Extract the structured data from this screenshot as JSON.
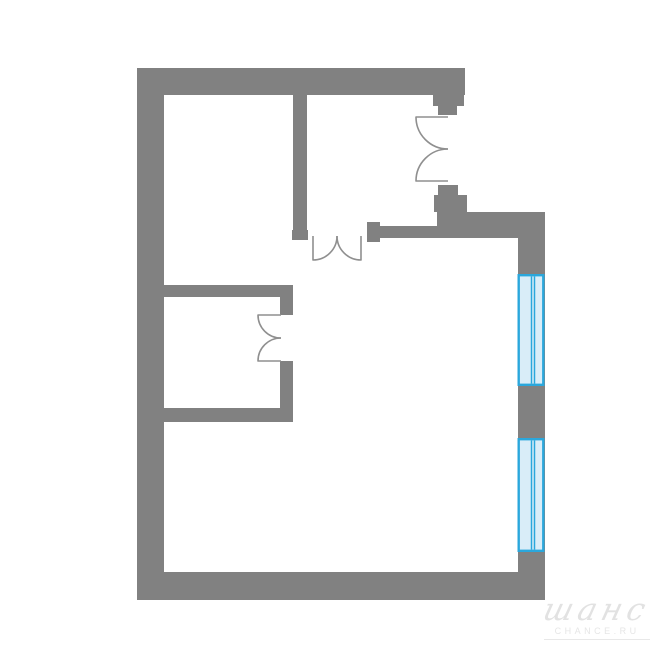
{
  "canvas": {
    "width": 670,
    "height": 670,
    "background": "#ffffff"
  },
  "colors": {
    "wall": "#818181",
    "door_line": "#8f8f8f",
    "window_border": "#2aa7dc",
    "window_fill": "#d9edf8",
    "watermark": "#e2e2e2"
  },
  "watermark": {
    "script": "шанс",
    "caption": "CHANCE.RU"
  },
  "floorplan": {
    "viewbox": "0 0 670 670",
    "walls": [
      {
        "name": "top-wall",
        "x": 137,
        "y": 68,
        "w": 328,
        "h": 27
      },
      {
        "name": "left-wall",
        "x": 137,
        "y": 68,
        "w": 27,
        "h": 532
      },
      {
        "name": "bottom-wall",
        "x": 137,
        "y": 572,
        "w": 408,
        "h": 28
      },
      {
        "name": "right-wall",
        "x": 518,
        "y": 212,
        "w": 27,
        "h": 388
      },
      {
        "name": "hall-wall",
        "x": 463,
        "y": 212,
        "w": 82,
        "h": 26
      },
      {
        "name": "entry-stub",
        "x": 437,
        "y": 195,
        "w": 26,
        "h": 43
      },
      {
        "name": "entry-stub-jamb-wide",
        "x": 434,
        "y": 195,
        "w": 33,
        "h": 17
      },
      {
        "name": "entry-stub-jamb-narrow",
        "x": 438,
        "y": 185,
        "w": 20,
        "h": 10
      },
      {
        "name": "top-wall-jamb-wide",
        "x": 433,
        "y": 95,
        "w": 31,
        "h": 11
      },
      {
        "name": "top-wall-jamb-narrow",
        "x": 438,
        "y": 106,
        "w": 19,
        "h": 9
      },
      {
        "name": "hall-partition",
        "x": 367,
        "y": 226,
        "w": 70,
        "h": 12
      },
      {
        "name": "hall-partition-jamb",
        "x": 367,
        "y": 222,
        "w": 13,
        "h": 20
      },
      {
        "name": "bedroom-partition",
        "x": 293,
        "y": 95,
        "w": 14,
        "h": 135
      },
      {
        "name": "bedroom-partition-jamb",
        "x": 292,
        "y": 230,
        "w": 16,
        "h": 10
      },
      {
        "name": "storage-top-wall",
        "x": 160,
        "y": 285,
        "w": 133,
        "h": 12
      },
      {
        "name": "storage-right-wall-top",
        "x": 280,
        "y": 297,
        "w": 13,
        "h": 18
      },
      {
        "name": "storage-right-wall-bottom",
        "x": 280,
        "y": 361,
        "w": 13,
        "h": 50
      },
      {
        "name": "storage-bottom-wall",
        "x": 160,
        "y": 408,
        "w": 133,
        "h": 14
      }
    ],
    "windows": [
      {
        "name": "window-1",
        "x": 517.5,
        "y": 274,
        "w": 27,
        "h": 112,
        "mullions": [
          531.5,
          534.5
        ]
      },
      {
        "name": "window-2",
        "x": 517.5,
        "y": 438,
        "w": 27,
        "h": 114,
        "mullions": [
          531.5,
          534.5
        ]
      }
    ],
    "doors": [
      {
        "name": "entry-door-leaf-top",
        "path": "M448,117 L416,117 A32,32 0 0 0 448,149"
      },
      {
        "name": "entry-door-leaf-bottom",
        "path": "M448,181 L416,181 A32,32 0 0 1 448,149"
      },
      {
        "name": "hall-door-leaf-left",
        "path": "M313,236 L313,260 A24,24 0 0 0 337,236"
      },
      {
        "name": "hall-door-leaf-right",
        "path": "M361,236 L361,260 A24,24 0 0 1 337,236"
      },
      {
        "name": "storage-door-leaf-top",
        "path": "M281,315 L258,315 A23,23 0 0 0 281,338"
      },
      {
        "name": "storage-door-leaf-bottom",
        "path": "M281,361 L258,361 A23,23 0 0 1 281,338"
      }
    ]
  }
}
